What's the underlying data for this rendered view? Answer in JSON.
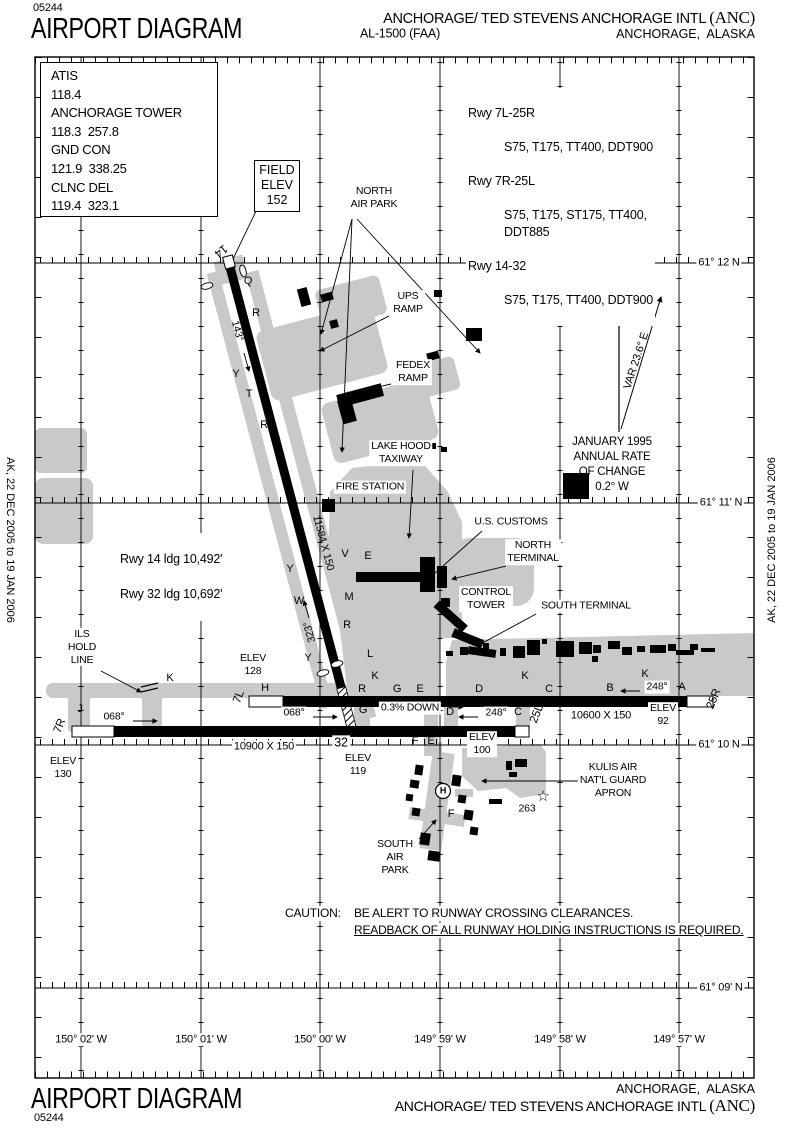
{
  "header": {
    "chart_id": "05244",
    "title": "AIRPORT DIAGRAM",
    "procedure_id": "AL-1500 (FAA)",
    "airport_name": "ANCHORAGE/ TED STEVENS ANCHORAGE INTL ",
    "airport_code": "(ANC)",
    "city": "ANCHORAGE,  ALASKA"
  },
  "footer": {
    "chart_id": "05244",
    "title": "AIRPORT DIAGRAM",
    "airport_name": "ANCHORAGE/ TED STEVENS ANCHORAGE INTL ",
    "airport_code": "(ANC)",
    "city": "ANCHORAGE,  ALASKA"
  },
  "side_dates": {
    "left": "AK, 22 DEC 2005 to 19 JAN 2006",
    "right": "AK, 22 DEC 2005 to 19 JAN 2006"
  },
  "comms": {
    "rows": [
      {
        "label": "ATIS",
        "value": "118.4"
      },
      {
        "label": "ANCHORAGE TOWER",
        "value": "118.3  257.8"
      },
      {
        "label": "GND CON",
        "value": "121.9  338.25"
      },
      {
        "label": "CLNC DEL",
        "value": "119.4  323.1"
      }
    ]
  },
  "field_elev_box": "FIELD\nELEV\n152",
  "runway_strength": {
    "rows": [
      {
        "rwy": "Rwy 7L-25R",
        "codes": "S75, T175, TT400, DDT900"
      },
      {
        "rwy": "Rwy 7R-25L",
        "codes": "S75, T175, ST175, TT400,\nDDT885"
      },
      {
        "rwy": "Rwy 14-32",
        "codes": "S75, T175, TT400, DDT900"
      }
    ]
  },
  "ldg_info": {
    "line1": "Rwy 14 ldg  10,492'",
    "line2": "Rwy 32 ldg  10,692'"
  },
  "magvar": {
    "var_label": "VAR 23.6° E",
    "note": "JANUARY 1995\nANNUAL RATE\nOF CHANGE\n0.2° W"
  },
  "caution": {
    "prefix": "CAUTION:",
    "line1": "BE ALERT TO RUNWAY CROSSING CLEARANCES.",
    "line2": "READBACK OF ALL RUNWAY HOLDING INSTRUCTIONS IS REQUIRED."
  },
  "map": {
    "labels": {
      "north_air_park": "NORTH\nAIR PARK",
      "ups_ramp": "UPS\nRAMP",
      "fedex_ramp": "FEDEX\nRAMP",
      "lake_hood": "LAKE HOOD\nTAXIWAY",
      "fire_station": "FIRE STATION",
      "us_customs": "U.S. CUSTOMS",
      "north_terminal": "NORTH\nTERMINAL",
      "control_tower": "CONTROL\nTOWER",
      "south_terminal": "SOUTH TERMINAL",
      "kulis": "KULIS AIR\nNAT'L GUARD\nAPRON",
      "south_air_park": "SOUTH\nAIR\nPARK",
      "ils_hold": "ILS\nHOLD\nLINE",
      "elev_128": "ELEV\n128",
      "elev_130": "ELEV\n130",
      "elev_119": "ELEV\n119",
      "elev_100": "ELEV\n100",
      "elev_92": "ELEV\n92",
      "num_263": "263",
      "star": "☆",
      "helipad": "H"
    },
    "runways": {
      "r14": "14",
      "r32": "32",
      "r7l": "7L",
      "r7r": "7R",
      "r25l": "25L",
      "r25r": "25R",
      "hdg_143": "143°",
      "hdg_323": "323°",
      "hdg_068": "068°",
      "hdg_248": "248°",
      "dim_14_32": "11584 X 150",
      "dim_7r_25l": "10900 X 150",
      "dim_7l_25r": "10600 X 150",
      "gradient": "0.3% DOWN"
    },
    "coords": {
      "lat": [
        "61° 12 N",
        "61° 11' N",
        "61° 10 N",
        "61° 09' N"
      ],
      "lon": [
        "150° 02' W",
        "150° 01' W",
        "150° 00' W",
        "149° 59' W",
        "149° 58' W",
        "149° 57' W"
      ]
    },
    "taxiway_letters": [
      {
        "t": "Q",
        "x": 248,
        "y": 281
      },
      {
        "t": "R",
        "x": 256,
        "y": 313
      },
      {
        "t": "S",
        "x": 248,
        "y": 336
      },
      {
        "t": "Y",
        "x": 236,
        "y": 374
      },
      {
        "t": "T",
        "x": 249,
        "y": 394
      },
      {
        "t": "R",
        "x": 264,
        "y": 425
      },
      {
        "t": "U",
        "x": 281,
        "y": 459
      },
      {
        "t": "V",
        "x": 345,
        "y": 554
      },
      {
        "t": "E",
        "x": 368,
        "y": 556
      },
      {
        "t": "Y",
        "x": 290,
        "y": 569
      },
      {
        "t": "M",
        "x": 349,
        "y": 597
      },
      {
        "t": "W",
        "x": 299,
        "y": 601
      },
      {
        "t": "R",
        "x": 347,
        "y": 625
      },
      {
        "t": "L",
        "x": 370,
        "y": 654
      },
      {
        "t": "Y",
        "x": 308,
        "y": 658
      },
      {
        "t": "K",
        "x": 375,
        "y": 676
      },
      {
        "t": "K",
        "x": 170,
        "y": 678
      },
      {
        "t": "J",
        "x": 80,
        "y": 709
      },
      {
        "t": "H",
        "x": 265,
        "y": 688
      },
      {
        "t": "R",
        "x": 362,
        "y": 689
      },
      {
        "t": "G",
        "x": 397,
        "y": 689
      },
      {
        "t": "E",
        "x": 420,
        "y": 689
      },
      {
        "t": "D",
        "x": 479,
        "y": 689
      },
      {
        "t": "C",
        "x": 549,
        "y": 689
      },
      {
        "t": "B",
        "x": 610,
        "y": 688
      },
      {
        "t": "A",
        "x": 682,
        "y": 687
      },
      {
        "t": "K",
        "x": 525,
        "y": 676
      },
      {
        "t": "K",
        "x": 645,
        "y": 674
      },
      {
        "t": "D",
        "x": 450,
        "y": 712
      },
      {
        "t": "C",
        "x": 518,
        "y": 712
      },
      {
        "t": "G",
        "x": 363,
        "y": 710
      },
      {
        "t": "F",
        "x": 415,
        "y": 741
      },
      {
        "t": "E",
        "x": 431,
        "y": 741
      },
      {
        "t": "F",
        "x": 451,
        "y": 814
      }
    ],
    "colors": {
      "apron_gray": "#c9c9c9",
      "ink": "#000000"
    }
  }
}
